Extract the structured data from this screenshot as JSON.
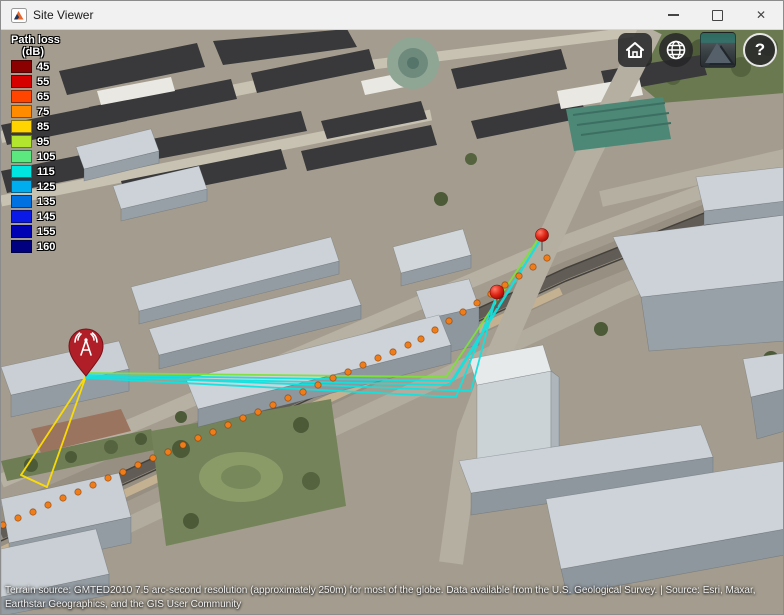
{
  "window": {
    "title": "Site Viewer",
    "minimize_label": "minimize",
    "maximize_label": "maximize",
    "close_label": "✕"
  },
  "legend": {
    "title": "Path loss",
    "unit": "(dB)",
    "entries": [
      {
        "label": "45",
        "color": "#8b0000"
      },
      {
        "label": "55",
        "color": "#d60000"
      },
      {
        "label": "65",
        "color": "#ff4500"
      },
      {
        "label": "75",
        "color": "#ff8c00"
      },
      {
        "label": "85",
        "color": "#ffd400"
      },
      {
        "label": "95",
        "color": "#b2e62e"
      },
      {
        "label": "105",
        "color": "#5ce87e"
      },
      {
        "label": "115",
        "color": "#00e5e0"
      },
      {
        "label": "125",
        "color": "#00aeef"
      },
      {
        "label": "135",
        "color": "#0071e0"
      },
      {
        "label": "145",
        "color": "#0a18e8"
      },
      {
        "label": "155",
        "color": "#0000b4"
      },
      {
        "label": "160",
        "color": "#000080"
      }
    ]
  },
  "toolbar": {
    "home": "home",
    "globe": "globe",
    "basemap": "satellite-basemap",
    "help_label": "?"
  },
  "attribution": {
    "line1": "Terrain source: GMTED2010 7.5 arc-second resolution (approximately 250m) for most of the globe. Data available from the U.S. Geological Survey. | Source: Esri, Maxar,",
    "line2": "Earthstar Geographics, and the GIS User Community"
  },
  "scene": {
    "ray_colors": {
      "cyan": "#12e2df",
      "green": "#7de23a",
      "yellow": "#ffdf00"
    },
    "rays": [
      {
        "color": "yellow",
        "points": [
          [
            85,
            347
          ],
          [
            20,
            446
          ]
        ]
      },
      {
        "color": "yellow",
        "points": [
          [
            85,
            347
          ],
          [
            46,
            458
          ]
        ]
      },
      {
        "color": "yellow",
        "points": [
          [
            20,
            446
          ],
          [
            46,
            458
          ]
        ]
      },
      {
        "color": "green",
        "points": [
          [
            85,
            344
          ],
          [
            445,
            348
          ],
          [
            538,
            209
          ]
        ]
      },
      {
        "color": "cyan",
        "points": [
          [
            85,
            347
          ],
          [
            470,
            362
          ],
          [
            496,
            264
          ]
        ]
      },
      {
        "color": "cyan",
        "points": [
          [
            85,
            349
          ],
          [
            455,
            368
          ],
          [
            496,
            266
          ]
        ]
      },
      {
        "color": "cyan",
        "points": [
          [
            85,
            348
          ],
          [
            448,
            356
          ],
          [
            541,
            208
          ]
        ]
      },
      {
        "color": "cyan",
        "points": [
          [
            85,
            346
          ],
          [
            452,
            352
          ],
          [
            540,
            210
          ]
        ]
      }
    ],
    "transmitter": {
      "x": 85,
      "tip_y": 347,
      "color": "#b01f28"
    },
    "receivers": [
      {
        "x": 496,
        "y": 263,
        "r": 7
      },
      {
        "x": 541,
        "y": 206,
        "r": 6.5
      }
    ],
    "route_dots": {
      "color": "#ef7d1a",
      "points": [
        [
          2,
          496
        ],
        [
          17,
          489
        ],
        [
          32,
          483
        ],
        [
          47,
          476
        ],
        [
          62,
          469
        ],
        [
          77,
          463
        ],
        [
          92,
          456
        ],
        [
          107,
          449
        ],
        [
          122,
          443
        ],
        [
          137,
          436
        ],
        [
          152,
          429
        ],
        [
          167,
          423
        ],
        [
          182,
          416
        ],
        [
          197,
          409
        ],
        [
          212,
          403
        ],
        [
          227,
          396
        ],
        [
          242,
          389
        ],
        [
          257,
          383
        ],
        [
          272,
          376
        ],
        [
          287,
          369
        ],
        [
          302,
          363
        ],
        [
          317,
          356
        ],
        [
          332,
          349
        ],
        [
          347,
          343
        ],
        [
          362,
          336
        ],
        [
          377,
          329
        ],
        [
          392,
          323
        ],
        [
          407,
          316
        ],
        [
          420,
          310
        ],
        [
          434,
          301
        ],
        [
          448,
          292
        ],
        [
          462,
          283
        ],
        [
          476,
          274
        ],
        [
          490,
          265
        ],
        [
          504,
          256
        ],
        [
          518,
          247
        ],
        [
          532,
          238
        ],
        [
          546,
          229
        ]
      ]
    }
  }
}
